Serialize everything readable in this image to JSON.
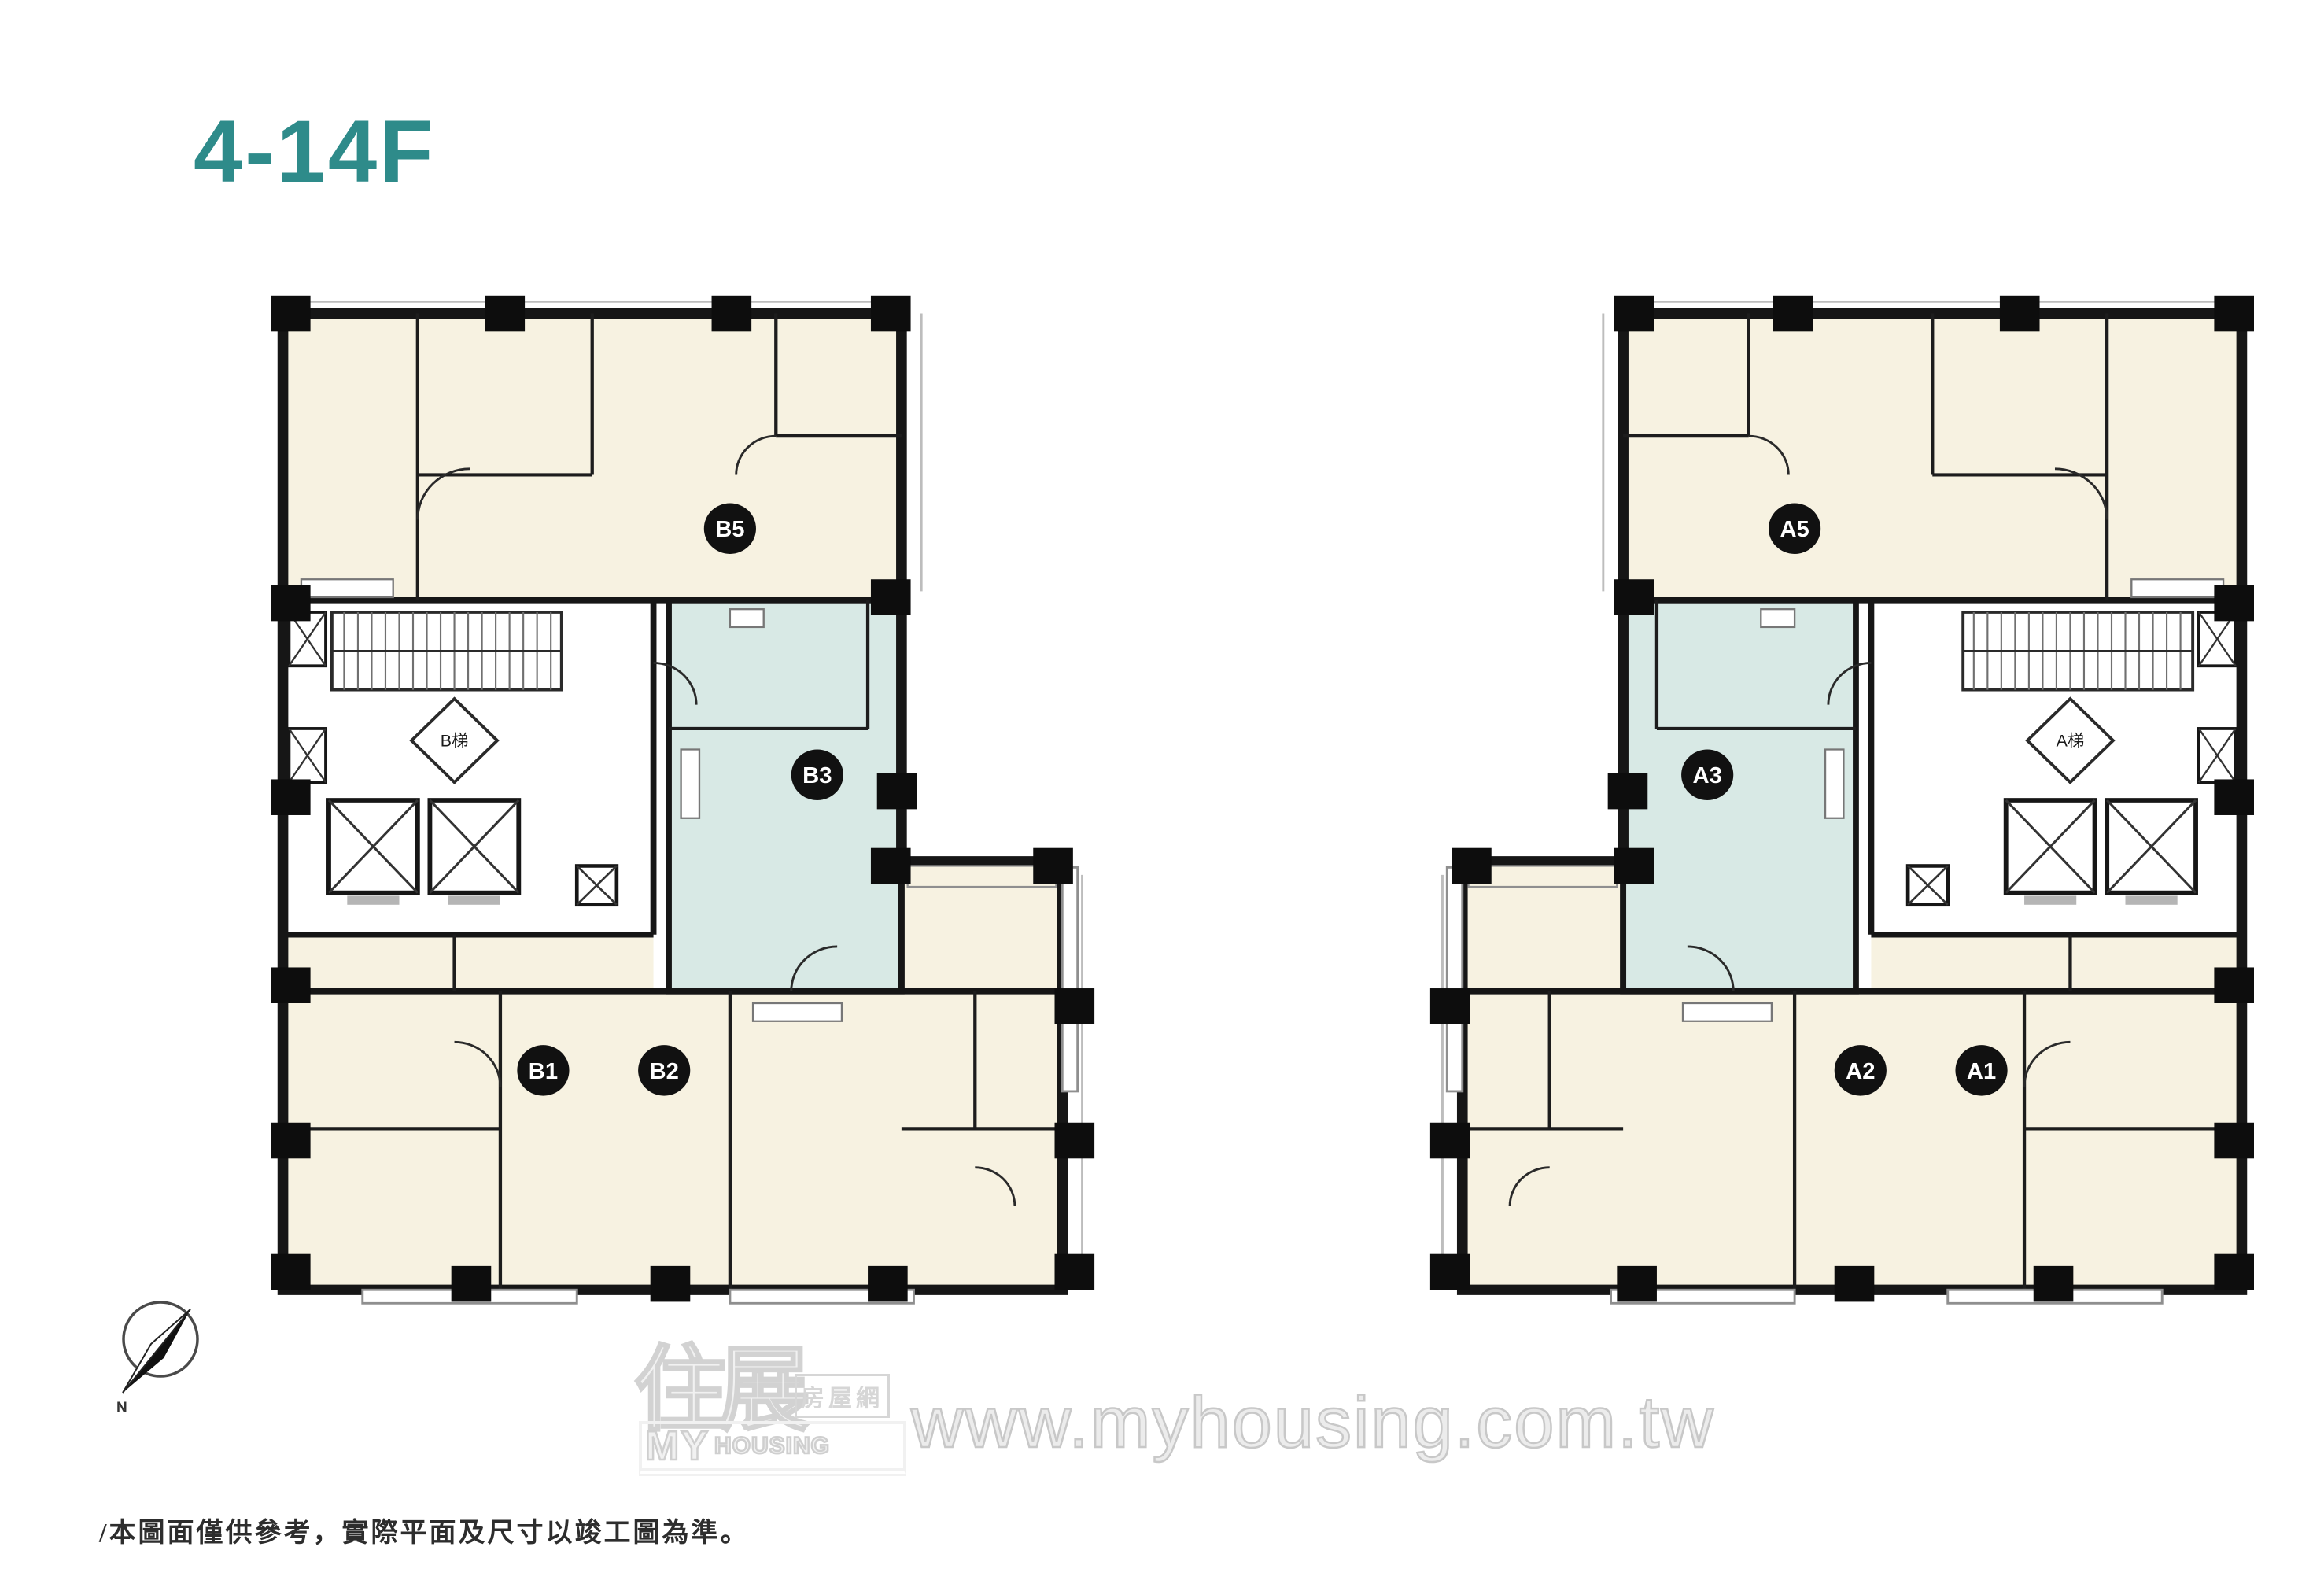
{
  "header": {
    "floor_range_label": "4-14F"
  },
  "plans": [
    {
      "building": "B",
      "stair_label": "B梯",
      "units": [
        {
          "id": "B5",
          "highlighted": false
        },
        {
          "id": "B3",
          "highlighted": true
        },
        {
          "id": "B1",
          "highlighted": false
        },
        {
          "id": "B2",
          "highlighted": false
        }
      ]
    },
    {
      "building": "A",
      "stair_label": "A梯",
      "units": [
        {
          "id": "A5",
          "highlighted": false
        },
        {
          "id": "A3",
          "highlighted": true
        },
        {
          "id": "A2",
          "highlighted": false
        },
        {
          "id": "A1",
          "highlighted": false
        }
      ]
    }
  ],
  "colors": {
    "title": "#2e8b8a",
    "room_standard": "#f7f2e1",
    "room_highlight": "#d8e9e5",
    "wall": "#161616",
    "unit_badge": "#111111",
    "unit_badge_text": "#ffffff",
    "watermark": "#d6d6d6"
  },
  "compass": {
    "north_label": "N"
  },
  "watermark": {
    "logo_zh_main": "住展",
    "logo_zh_sub": "房屋網",
    "logo_en_top": "MY",
    "logo_en_bottom": "HOUSING",
    "site_url": "www.myhousing.com.tw"
  },
  "footer": {
    "disclaimer": "/本圖面僅供參考，實際平面及尺寸以竣工圖為準。"
  }
}
